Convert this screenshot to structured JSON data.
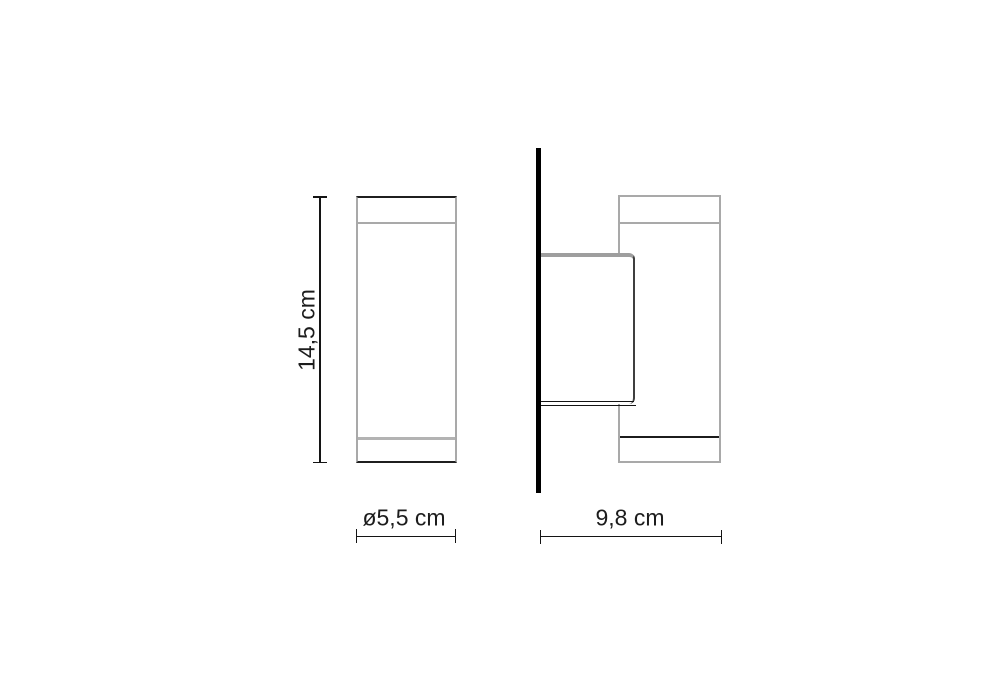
{
  "drawing": {
    "front_view": {
      "height_label": "14,5 cm",
      "diameter_label": "ø5,5 cm"
    },
    "side_view": {
      "depth_label": "9,8 cm"
    },
    "colors": {
      "line_dark": "#141414",
      "line_gray": "#a9a9a9",
      "bracket_gray": "#9e9e9e",
      "wall_black": "#000000",
      "text": "#1c1c1c",
      "background": "#ffffff"
    }
  }
}
